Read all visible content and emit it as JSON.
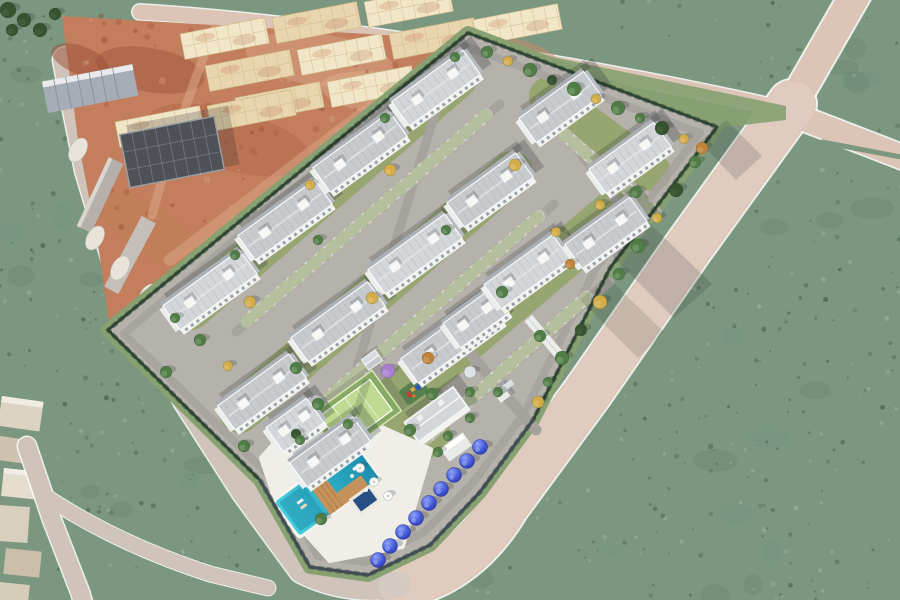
{
  "meta": {
    "type": "aerial-3d-architectural-render",
    "subject": "residential condominium complex under marketing render, adjacent construction site, perimeter roads and open green fields",
    "buildings_count": 16,
    "floors_per_building": 4,
    "amenities": [
      "swimming-pool",
      "kids-pool",
      "wood-deck",
      "sun-umbrellas",
      "tennis-court",
      "playground",
      "clubhouse",
      "kiosk",
      "entrance-gate",
      "perimeter-fence",
      "parking-lots",
      "palm-trees",
      "blue-ornamental-trees"
    ]
  },
  "palette": {
    "field": "#7b977f",
    "fieldDark": "#3f5a48",
    "fieldLight": "#a8bba2",
    "roadPink": "#dcc4b6",
    "roadGray": "#cfc3ba",
    "streetGray": "#a6a39e",
    "parking": "#b0ada8",
    "grassPaver": "#93a765",
    "paving": "#b5b1ab",
    "earth": "#c27e5d",
    "earthDark": "#a55a42",
    "earthLight": "#d8a183",
    "slab": "#e9d6ae",
    "slabLight": "#f2e6c8",
    "roof": "#c7cbce",
    "roofLight": "#d3d7da",
    "roofLine": "#a2a8ad",
    "facade": "#f3f4f2",
    "window": "#7b848d",
    "hedge": "#2f4733",
    "fence": "#454e5a",
    "verge": "#87a173",
    "lawn": "#97a571",
    "pool1": "#45cede",
    "pool2": "#1b8fae",
    "deck": "#efeee8",
    "wood": "#c6925b",
    "tennisIn": "#bfdb92",
    "tennisOut": "#86a964",
    "mat": "#567f4e",
    "treeG": "#507c46",
    "treeD": "#35532f",
    "treeY": "#d3ac48",
    "treeO": "#c08138",
    "treeP": "#a97fd1",
    "treeW": "#dde2e6",
    "blue1": "#4157d8",
    "blue2": "#232f95",
    "shadowColor": "#1e2428",
    "carColors": [
      "#f2f2f2",
      "#d6d8da",
      "#54595f",
      "#2a2d31",
      "#8e3731",
      "#32508f",
      "#c8c2b6",
      "#7d8288"
    ]
  },
  "scene": {
    "buildings": [
      [
        210,
        290,
        95
      ],
      [
        285,
        220,
        95
      ],
      [
        360,
        152,
        95
      ],
      [
        436,
        88,
        88
      ],
      [
        262,
        392,
        88
      ],
      [
        338,
        322,
        95
      ],
      [
        415,
        254,
        95
      ],
      [
        490,
        190,
        85
      ],
      [
        330,
        452,
        78
      ],
      [
        295,
        425,
        50
      ],
      [
        452,
        340,
        105
      ],
      [
        476,
        318,
        60
      ],
      [
        527,
        272,
        85
      ],
      [
        606,
        233,
        80
      ],
      [
        560,
        107,
        80
      ],
      [
        630,
        158,
        80
      ]
    ],
    "trees": [
      [
        487,
        52,
        6,
        "g"
      ],
      [
        508,
        61,
        5,
        "y"
      ],
      [
        530,
        70,
        7,
        "g"
      ],
      [
        552,
        80,
        5,
        "d"
      ],
      [
        574,
        89,
        7,
        "g"
      ],
      [
        596,
        99,
        5,
        "y"
      ],
      [
        618,
        108,
        7,
        "g"
      ],
      [
        640,
        118,
        5,
        "g"
      ],
      [
        662,
        128,
        7,
        "d"
      ],
      [
        684,
        139,
        5,
        "y"
      ],
      [
        702,
        148,
        6,
        "o"
      ],
      [
        695,
        162,
        6,
        "g"
      ],
      [
        676,
        190,
        7,
        "d"
      ],
      [
        657,
        218,
        5,
        "y"
      ],
      [
        638,
        246,
        7,
        "g"
      ],
      [
        619,
        274,
        6,
        "g"
      ],
      [
        600,
        302,
        7,
        "y"
      ],
      [
        581,
        330,
        6,
        "d"
      ],
      [
        562,
        358,
        7,
        "g"
      ],
      [
        548,
        382,
        5,
        "g"
      ],
      [
        538,
        402,
        6,
        "y"
      ],
      [
        250,
        302,
        6,
        "y"
      ],
      [
        318,
        240,
        5,
        "g"
      ],
      [
        390,
        170,
        6,
        "y"
      ],
      [
        296,
        368,
        6,
        "g"
      ],
      [
        372,
        298,
        6,
        "y"
      ],
      [
        446,
        230,
        5,
        "g"
      ],
      [
        515,
        165,
        6,
        "y"
      ],
      [
        348,
        424,
        5,
        "g"
      ],
      [
        428,
        358,
        6,
        "o"
      ],
      [
        502,
        292,
        6,
        "g"
      ],
      [
        556,
        232,
        5,
        "y"
      ],
      [
        470,
        392,
        5,
        "g"
      ],
      [
        540,
        336,
        6,
        "g"
      ],
      [
        296,
        434,
        5,
        "d"
      ],
      [
        600,
        205,
        5,
        "y"
      ],
      [
        636,
        192,
        6,
        "g"
      ],
      [
        570,
        264,
        5,
        "o"
      ],
      [
        448,
        436,
        5,
        "g"
      ],
      [
        200,
        340,
        6,
        "g"
      ],
      [
        228,
        366,
        5,
        "y"
      ],
      [
        175,
        318,
        5,
        "g"
      ],
      [
        235,
        255,
        5,
        "g"
      ],
      [
        310,
        185,
        5,
        "y"
      ],
      [
        385,
        118,
        5,
        "g"
      ],
      [
        455,
        57,
        5,
        "g"
      ],
      [
        318,
        404,
        6,
        "g"
      ],
      [
        300,
        440,
        5,
        "g"
      ],
      [
        410,
        430,
        6,
        "g"
      ],
      [
        438,
        452,
        5,
        "g"
      ],
      [
        470,
        418,
        5,
        "g"
      ],
      [
        388,
        371,
        7,
        "p"
      ],
      [
        470,
        372,
        6,
        "w"
      ],
      [
        498,
        392,
        5,
        "g"
      ],
      [
        432,
        394,
        6,
        "g"
      ],
      [
        166,
        372,
        6,
        "g"
      ],
      [
        244,
        446,
        6,
        "g"
      ],
      [
        321,
        519,
        6,
        "g"
      ],
      [
        8,
        10,
        8,
        "d"
      ],
      [
        24,
        20,
        7,
        "d"
      ],
      [
        40,
        30,
        7,
        "d"
      ],
      [
        12,
        30,
        6,
        "d"
      ],
      [
        55,
        14,
        6,
        "d"
      ]
    ],
    "palms": [
      [
        302,
        452
      ],
      [
        286,
        480
      ],
      [
        270,
        506
      ],
      [
        205,
        409
      ],
      [
        245,
        444
      ],
      [
        316,
        540
      ],
      [
        592,
        318
      ],
      [
        566,
        352
      ],
      [
        433,
        468
      ]
    ],
    "blueTrees": [
      [
        480,
        447
      ],
      [
        467,
        461
      ],
      [
        454,
        475
      ],
      [
        441,
        489
      ],
      [
        429,
        503
      ],
      [
        416,
        518
      ],
      [
        403,
        532
      ],
      [
        390,
        546
      ],
      [
        378,
        560
      ]
    ],
    "carBands": [
      [
        247,
        321,
        486,
        115,
        20
      ],
      [
        299,
        423,
        540,
        215,
        20
      ],
      [
        377,
        481,
        588,
        296,
        18
      ],
      [
        565,
        135,
        655,
        213,
        8
      ]
    ],
    "cars": [
      [
        543,
        447,
        127,
        "#ececea",
        0
      ],
      [
        552,
        468,
        127,
        "#33373d",
        0
      ],
      [
        48,
        505,
        73,
        "#2a2d31",
        0
      ],
      [
        104,
        238,
        73,
        "#f0f0ee",
        0
      ],
      [
        218,
        16,
        8,
        "#e8e8e8",
        1
      ],
      [
        258,
        23,
        8,
        "#d8d4cc",
        1
      ],
      [
        170,
        40,
        8,
        "#dfe0dc",
        1
      ],
      [
        695,
        97,
        35,
        "#f4f4f2",
        0
      ]
    ],
    "slabPlates": [
      [
        180,
        34
      ],
      [
        272,
        18
      ],
      [
        364,
        2
      ],
      [
        205,
        66
      ],
      [
        297,
        50
      ],
      [
        389,
        34
      ],
      [
        473,
        20
      ],
      [
        235,
        98
      ],
      [
        327,
        82
      ],
      [
        419,
        66
      ],
      [
        115,
        122
      ],
      [
        207,
        106
      ]
    ],
    "mounds": [
      [
        95,
        238
      ],
      [
        120,
        268
      ],
      [
        148,
        296
      ],
      [
        78,
        150
      ]
    ],
    "palmShadows": [
      [
        594,
        316
      ],
      [
        568,
        352
      ],
      [
        620,
        282
      ],
      [
        646,
        250
      ],
      [
        672,
        216
      ]
    ]
  }
}
